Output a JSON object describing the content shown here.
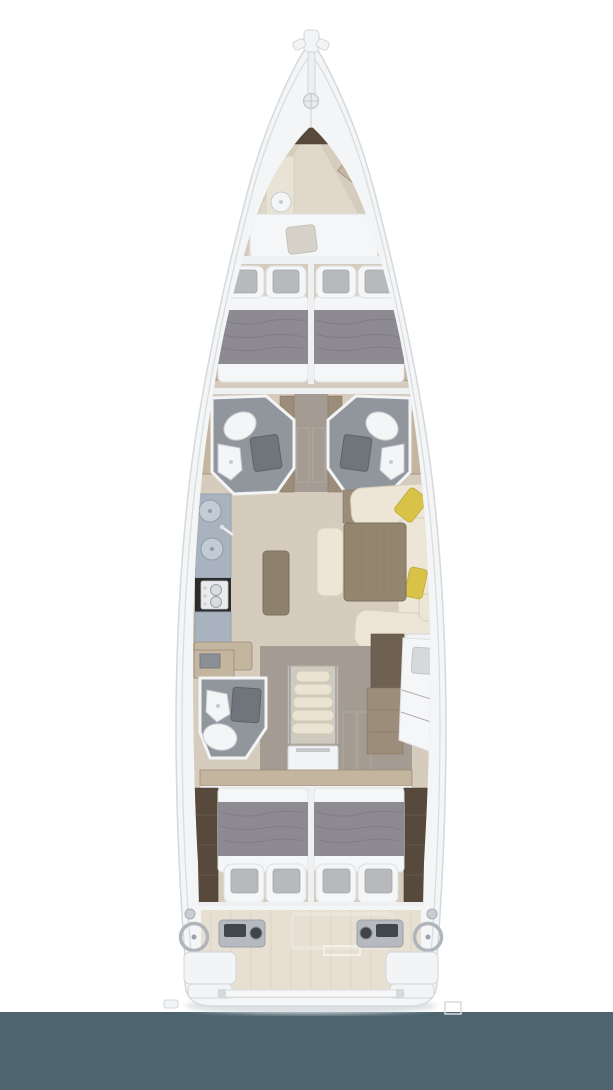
{
  "meta": {
    "title": "Sailing yacht interior layout plan - overhead view",
    "type": "floor-plan",
    "orientation": "bow-up"
  },
  "palette": {
    "page-bg": "#ffffff",
    "footer": "#4e6570",
    "hull": "#f3f5f6",
    "hull-edge": "#d4d9dc",
    "deck-line": "#d7dcdf",
    "floor": "#d6ccbe",
    "floor-light": "#e0d8ca",
    "corridor": "#a49c92",
    "wood-tan": "#c4b59f",
    "wood-mid": "#9b8d79",
    "wood-dark": "#6e6152",
    "wood-darker": "#57493c",
    "bath": "#91969d",
    "shower": "#70757c",
    "fixture": "#f4f5f6",
    "fixture-edge": "#c6cace",
    "bed": "#f5f6f7",
    "bed-edge": "#dddfe2",
    "blanket": "#8d8a92",
    "blanket-dark": "#76737c",
    "cushion": "#b7b9bd",
    "sofa": "#ede6d7",
    "sofa-edge": "#d8cfba",
    "wood-table": "#93866f",
    "island": "#8d806c",
    "counter": "#a9b3bf",
    "counter-edge": "#93a2b0",
    "stove": "#2a2c2e",
    "cooktop": "#e9ebed",
    "yellow": "#d8c348",
    "steps": "#eae3d2",
    "steps-edge": "#cfc8b6",
    "panel": "#f2f4f5",
    "panel-edge": "#d2d6d9",
    "bulkhead": "#eef0f2",
    "cockpit": "#e6dfd2",
    "plank": "#d8d1c3",
    "console": "#b6bac0",
    "screen": "#41464c",
    "wheel": "#b0b5ba"
  },
  "vessel": {
    "view": "overhead deck and interior plan of a sailing yacht",
    "areas": [
      {
        "id": "bow-deck",
        "label": "Bow deck with bowsprit, anchor track and windlass"
      },
      {
        "id": "forepeak-cabin",
        "label": "Forepeak crew cabin with transverse berth and round sink"
      },
      {
        "id": "forward-cabin-port",
        "label": "Forward double cabin, port, gray blanket and two headboard cushions"
      },
      {
        "id": "forward-cabin-starboard",
        "label": "Forward double cabin, starboard, gray blanket and two headboard cushions"
      },
      {
        "id": "head-forward-port",
        "label": "Forward head with toilet, sink and shower, port"
      },
      {
        "id": "head-forward-starboard",
        "label": "Forward head with toilet, sink and shower, starboard"
      },
      {
        "id": "corridor-forward",
        "label": "Central corridor between forward heads"
      },
      {
        "id": "galley",
        "label": "Galley with twin round sinks, stove and counters, port"
      },
      {
        "id": "salon",
        "label": "Salon with U-shaped sofa, yellow pillows, dining table and bench, starboard"
      },
      {
        "id": "head-aft-port",
        "label": "Aft head with toilet, sink and shower, port"
      },
      {
        "id": "companionway",
        "label": "Companionway steps with engine hatch"
      },
      {
        "id": "berth-aft-starboard",
        "label": "Diagonal single berth with pillow, starboard aft"
      },
      {
        "id": "aft-cabin-port",
        "label": "Aft double cabin, port, gray blanket and two cushioned seats"
      },
      {
        "id": "aft-cabin-starboard",
        "label": "Aft double cabin, starboard, gray blanket and two cushioned seats"
      },
      {
        "id": "cockpit",
        "label": "Cockpit with teak floor and center hatch"
      },
      {
        "id": "helm-port",
        "label": "Port helm station with wheel, instrument console and seat"
      },
      {
        "id": "helm-starboard",
        "label": "Starboard helm station with wheel, instrument console and seat"
      },
      {
        "id": "stern",
        "label": "Transom with mainsheet traveler and swim platform fitting"
      }
    ],
    "counts": {
      "double_cabins": 4,
      "single_berths": 2,
      "heads": 3,
      "helm_stations": 2
    }
  }
}
